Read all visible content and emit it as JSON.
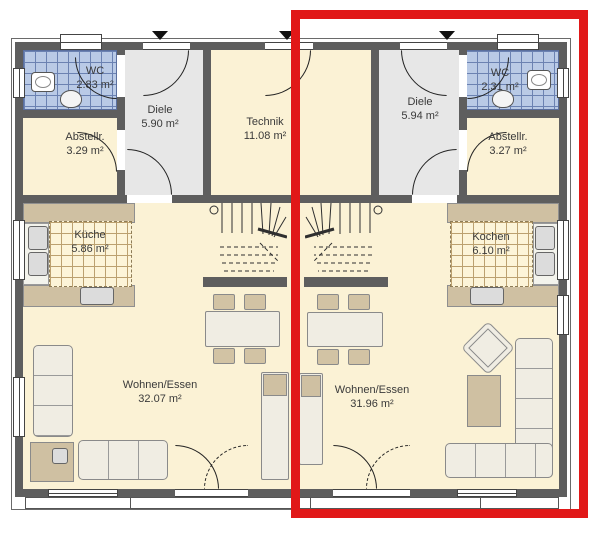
{
  "plan_title": "floor-plan-ground-floor-duplex",
  "colors": {
    "highlight_red": "#e11818",
    "wall_gray": "#5e5e5e",
    "floor_cream": "#fbf2d5",
    "floor_gray": "#e7e7e7",
    "wc_tile_blue": "#b9cae6",
    "counter_tan": "#cfc0a2",
    "furniture_light": "#f0ede3"
  },
  "rooms": [
    {
      "name": "WC",
      "area": "2.83 m²"
    },
    {
      "name": "Diele",
      "area": "5.90 m²"
    },
    {
      "name": "Abstellr.",
      "area": "3.29 m²"
    },
    {
      "name": "Technik",
      "area": "11.08 m²"
    },
    {
      "name": "Diele",
      "area": "5.94 m²"
    },
    {
      "name": "WC",
      "area": "2.31 m²"
    },
    {
      "name": "Abstellr.",
      "area": "3.27 m²"
    },
    {
      "name": "Küche",
      "area": "5.86 m²"
    },
    {
      "name": "Kochen",
      "area": "6.10 m²"
    },
    {
      "name": "Wohnen/Essen",
      "area": "32.07 m²"
    },
    {
      "name": "Wohnen/Essen",
      "area": "31.96 m²"
    }
  ]
}
